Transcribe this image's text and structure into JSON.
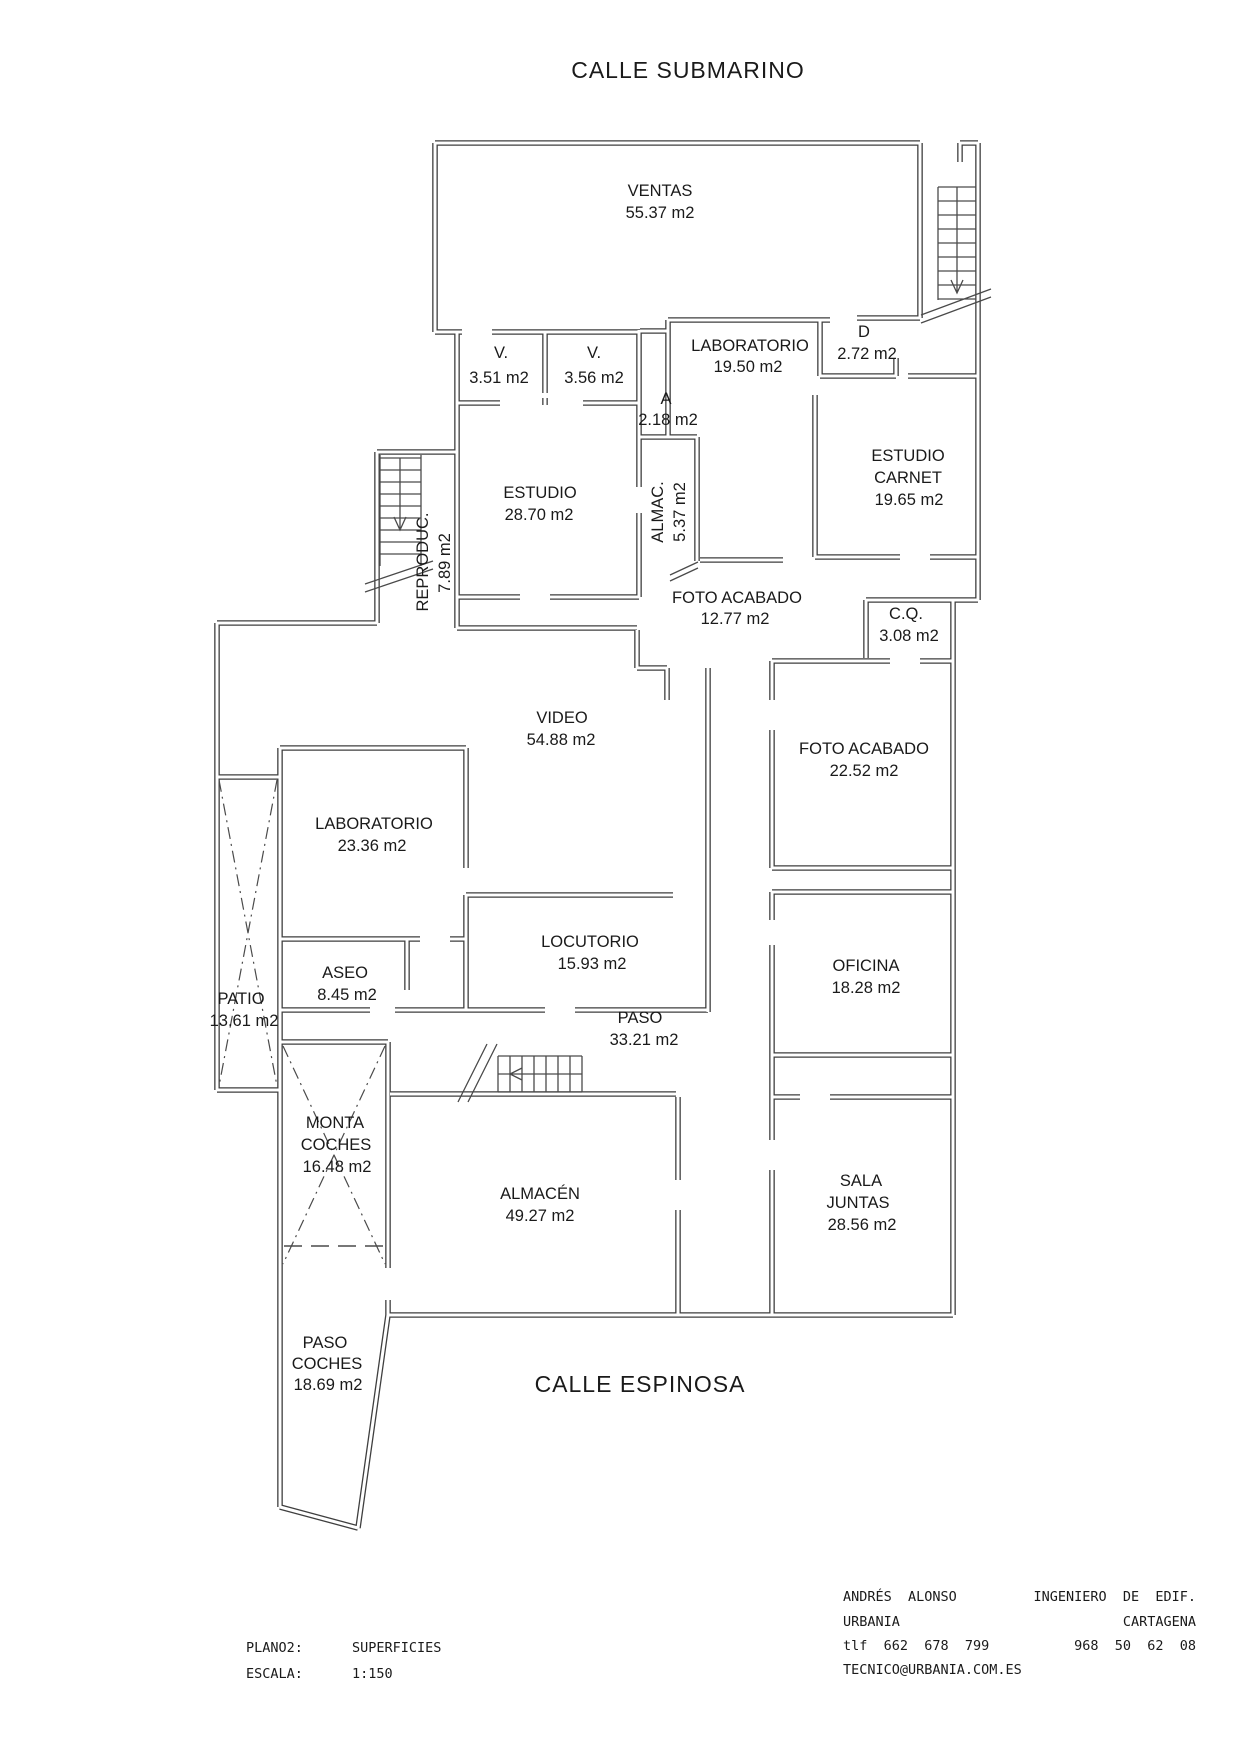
{
  "drawing": {
    "type": "architectural-floor-plan",
    "streets": {
      "top": "CALLE SUBMARINO",
      "bottom": "CALLE ESPINOSA"
    },
    "colors": {
      "wall": "#3f3f3f",
      "text": "#1a1a1a",
      "background": "#ffffff"
    }
  },
  "rooms": {
    "ventas": {
      "lines": [
        "VENTAS",
        "55.37 m2"
      ]
    },
    "v1": {
      "lines": [
        "V.",
        "3.51 m2"
      ]
    },
    "v2": {
      "lines": [
        "V.",
        "3.56 m2"
      ]
    },
    "laboratorio1": {
      "lines": [
        "LABORATORIO",
        "19.50 m2"
      ]
    },
    "d": {
      "lines": [
        "D",
        "2.72 m2"
      ]
    },
    "a": {
      "lines": [
        "A",
        "2.18 m2"
      ]
    },
    "estudio": {
      "lines": [
        "ESTUDIO",
        "28.70 m2"
      ]
    },
    "almac": {
      "lines": [
        "ALMAC.",
        "5.37 m2"
      ]
    },
    "reproduc": {
      "lines": [
        "REPRODUC.",
        "7.89 m2"
      ]
    },
    "estudio_carnet": {
      "lines": [
        "ESTUDIO",
        "CARNET",
        "19.65 m2"
      ]
    },
    "foto_acabado1": {
      "lines": [
        "FOTO ACABADO",
        "12.77 m2"
      ]
    },
    "cq": {
      "lines": [
        "C.Q.",
        "3.08 m2"
      ]
    },
    "video": {
      "lines": [
        "VIDEO",
        "54.88 m2"
      ]
    },
    "foto_acabado2": {
      "lines": [
        "FOTO ACABADO",
        "22.52 m2"
      ]
    },
    "laboratorio2": {
      "lines": [
        "LABORATORIO",
        "23.36 m2"
      ]
    },
    "locutorio": {
      "lines": [
        "LOCUTORIO",
        "15.93 m2"
      ]
    },
    "aseo": {
      "lines": [
        "ASEO",
        "8.45 m2"
      ]
    },
    "oficina": {
      "lines": [
        "OFICINA",
        "18.28 m2"
      ]
    },
    "patio": {
      "lines": [
        "PATIO",
        "13.61 m2"
      ]
    },
    "paso": {
      "lines": [
        "PASO",
        "33.21 m2"
      ]
    },
    "monta_coches": {
      "lines": [
        "MONTA",
        "COCHES",
        "16.48 m2"
      ]
    },
    "almacen": {
      "lines": [
        "ALMACÉN",
        "49.27 m2"
      ]
    },
    "sala_juntas": {
      "lines": [
        "SALA",
        "JUNTAS",
        "28.56 m2"
      ]
    },
    "paso_coches": {
      "lines": [
        "PASO",
        "COCHES",
        "18.69 m2"
      ]
    }
  },
  "footer": {
    "plano_label": "PLANO2:",
    "plano_value": "SUPERFICIES",
    "escala_label": "ESCALA:",
    "escala_value": "1:150",
    "author": "ANDRÉS  ALONSO",
    "company": "URBANIA",
    "phone": "tlf  662  678  799",
    "email": "TECNICO@URBANIA.COM.ES",
    "title_right": "INGENIERO  DE  EDIF.",
    "city_right": "CARTAGENA",
    "phone_right": "968  50  62  08"
  }
}
